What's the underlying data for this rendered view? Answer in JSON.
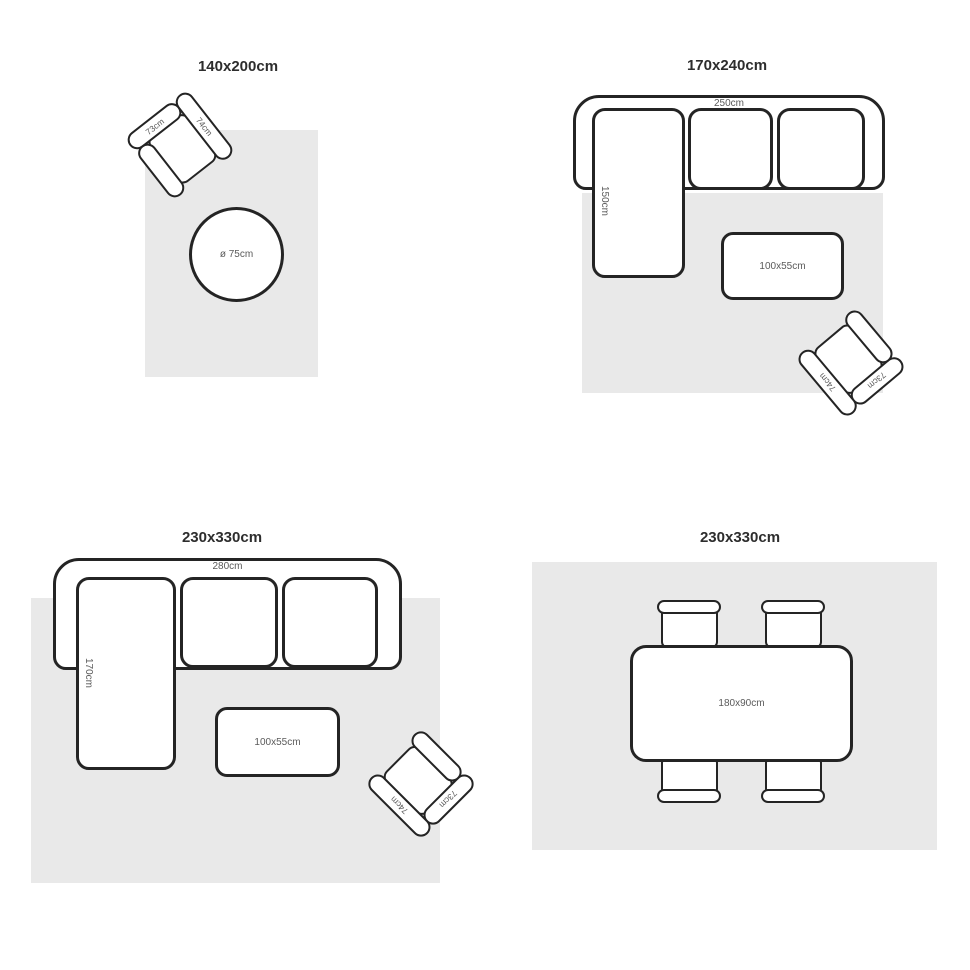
{
  "colors": {
    "background": "#ffffff",
    "rug_fill": "#e9e9e9",
    "outline": "#242424",
    "dimension_label": "#5a5a5a",
    "title_text": "#2d2d2d",
    "furniture_fill": "#ffffff"
  },
  "panels": [
    {
      "title": "140x200cm",
      "armchair": {
        "back_label": "73cm",
        "arm_label": "74cm"
      },
      "side_table_label": "ø 75cm"
    },
    {
      "title": "170x240cm",
      "sofa": {
        "width_label": "250cm",
        "chaise_label": "150cm"
      },
      "coffee_table_label": "100x55cm",
      "armchair": {
        "back_label": "73cm",
        "arm_label": "74cm"
      }
    },
    {
      "title": "230x330cm",
      "sofa": {
        "width_label": "280cm",
        "chaise_label": "170cm"
      },
      "coffee_table_label": "100x55cm",
      "armchair": {
        "back_label": "73cm",
        "arm_label": "74cm"
      }
    },
    {
      "title": "230x330cm",
      "dining_table_label": "180x90cm"
    }
  ]
}
